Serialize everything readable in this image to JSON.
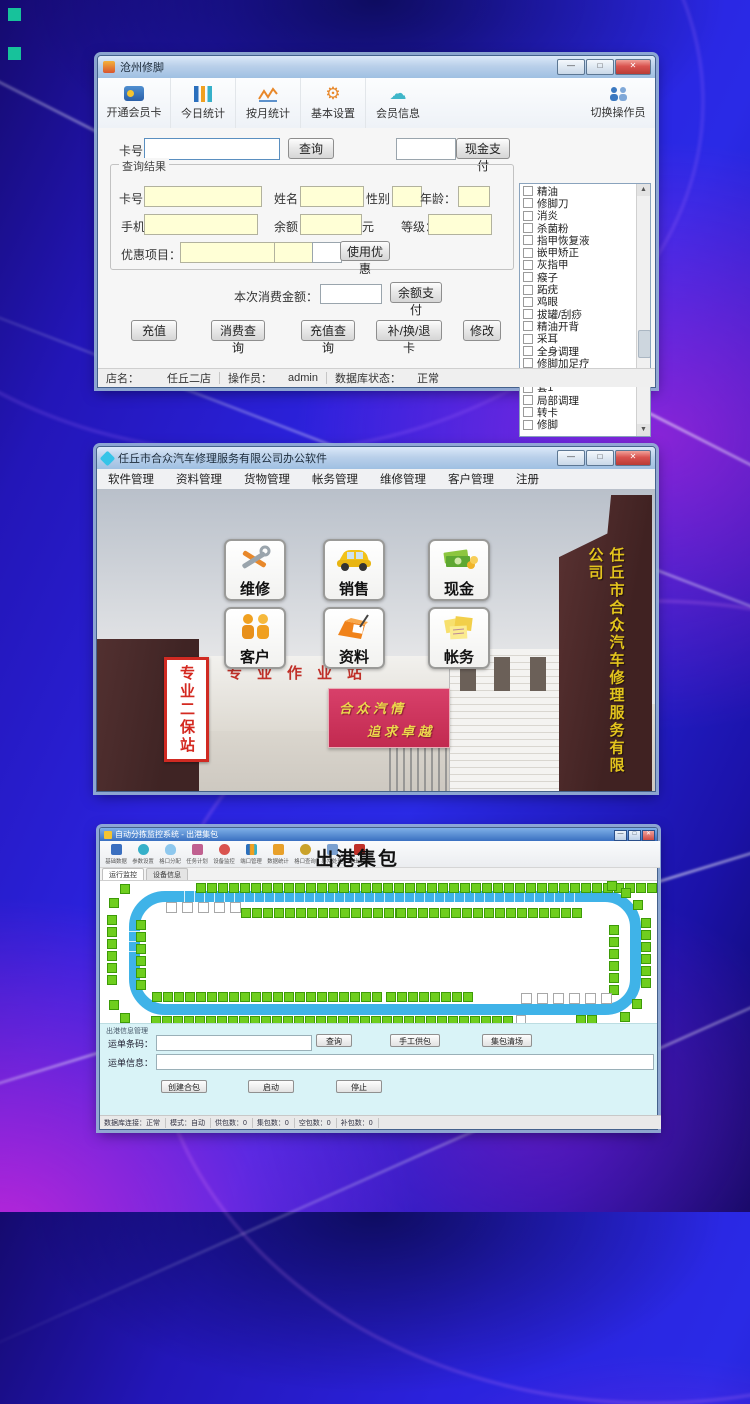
{
  "colors": {
    "track_blue": "#3fb3e8",
    "slot_green": "#6fce1e",
    "accent_magenta": "#d028d0",
    "window_frame": "#9fc0e2"
  },
  "window1": {
    "title": "沧州修脚",
    "toolbar": {
      "items": [
        {
          "label": "开通会员卡"
        },
        {
          "label": "今日统计"
        },
        {
          "label": "按月统计"
        },
        {
          "label": "基本设置"
        },
        {
          "label": "会员信息"
        }
      ],
      "switch_label": "切换操作员"
    },
    "search": {
      "card_label": "卡号：",
      "query": "查询",
      "cash_pay": "现金支付"
    },
    "result": {
      "group": "查询结果",
      "card": "卡号：",
      "name": "姓名：",
      "gender": "性别：",
      "age": "年龄：",
      "phone": "手机：",
      "balance": "余额：",
      "yuan": "元",
      "level": "等级：",
      "discount": "优惠项目：",
      "use_discount": "使用优惠"
    },
    "pay": {
      "consume_label": "本次消费金额：",
      "balance_pay": "余额支付"
    },
    "actions": [
      "充值",
      "消费查询",
      "充值查询",
      "补/换/退卡",
      "修改"
    ],
    "services": [
      "精油",
      "修脚刀",
      "消炎",
      "杀菌粉",
      "指甲恢复液",
      "嵌甲矫正",
      "灰指甲",
      "瘊子",
      "跖疣",
      "鸡眼",
      "拔罐/刮痧",
      "精油开背",
      "采耳",
      "全身调理",
      "修脚加足疗",
      "套2",
      "套1",
      "局部调理",
      "转卡",
      "修脚"
    ],
    "status": {
      "store_label": "店名：",
      "store": "任丘二店",
      "op_label": "操作员：",
      "op": "admin",
      "db_label": "数据库状态：",
      "db": "正常"
    }
  },
  "window2": {
    "title": "任丘市合众汽车修理服务有限公司办公软件",
    "menu": [
      "软件管理",
      "资料管理",
      "货物管理",
      "帐务管理",
      "维修管理",
      "客户管理",
      "注册"
    ],
    "tiles": [
      {
        "label": "维修"
      },
      {
        "label": "销售"
      },
      {
        "label": "现金"
      },
      {
        "label": "客户"
      },
      {
        "label": "资料"
      },
      {
        "label": "帐务"
      }
    ],
    "photo": {
      "left_sign": "专业二保站",
      "gate_text": "专业作业站",
      "slogan1": "合众汽情",
      "slogan2": "追求卓越",
      "tower": "任丘市合众汽车修理服务有限公司"
    }
  },
  "window3": {
    "title": "自动分拣监控系统 - 出港集包",
    "heading": "出港集包",
    "toolbar": [
      {
        "label": "基础数据"
      },
      {
        "label": "参数设置"
      },
      {
        "label": "格口分配"
      },
      {
        "label": "任务计划"
      },
      {
        "label": "设备监控"
      },
      {
        "label": "端口管理"
      },
      {
        "label": "数据统计"
      },
      {
        "label": "格口查询"
      },
      {
        "label": "异常处理"
      },
      {
        "label": "退出系统"
      }
    ],
    "tabs": [
      "运行监控",
      "设备信息"
    ],
    "conveyor": {
      "outer_top": 42,
      "inner_top_left": 15,
      "inner_top_right": 17,
      "white_top": 5,
      "left_outer": 6,
      "left_inner": 6,
      "right_outer": 6,
      "right_inner": 6,
      "inner_bottom_left": 21,
      "inner_bottom_right": 8,
      "white_bottom": 6,
      "outer_bottom": 33,
      "bottom_pair": 2
    },
    "form": {
      "section": "出港信息管理",
      "barcode_label": "运单条码：",
      "query": "查询",
      "manual": "手工供包",
      "clear": "集包清场",
      "info_label": "运单信息：",
      "create": "创建合包",
      "start": "启动",
      "stop": "停止"
    },
    "status_segments": [
      "数据库连接：正常",
      "模式：自动",
      "供包数：0",
      "集包数：0",
      "空包数：0",
      "补包数：0"
    ]
  }
}
